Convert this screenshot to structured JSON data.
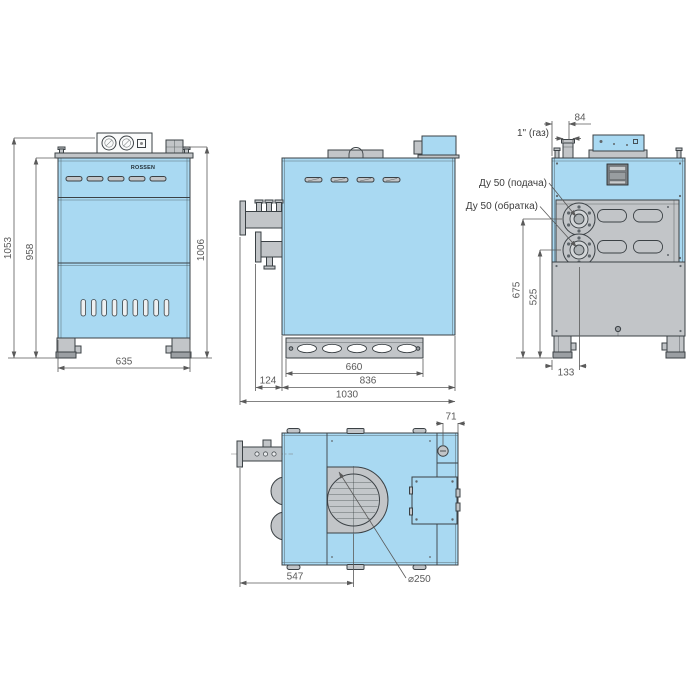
{
  "views": {
    "front": {
      "brand": "ROSSEN",
      "dims": {
        "total_height": "1053",
        "body_height": "958",
        "flue_height": "1006",
        "width": "635"
      }
    },
    "side": {
      "dims": {
        "pipe_protrusion": "124",
        "base_width": "660",
        "body_depth": "836",
        "total_depth": "1030"
      }
    },
    "back": {
      "labels": {
        "gas_size": "1\" (газ)",
        "supply": "Ду 50 (подача)",
        "return_line": "Ду 50 (обратка)"
      },
      "dims": {
        "gas_offset": "84",
        "supply_height": "675",
        "return_height": "525",
        "flange_offset": "133"
      }
    },
    "plan": {
      "dims": {
        "gas_edge_offset": "71",
        "flue_center_offset": "547",
        "flue_diameter": "⌀250"
      }
    }
  },
  "colors": {
    "blue": "#a9d9f2",
    "gray": "#c2c5c8",
    "gray_dark": "#9b9fa3",
    "line": "#3b4145",
    "dim": "#5a5a5a"
  }
}
